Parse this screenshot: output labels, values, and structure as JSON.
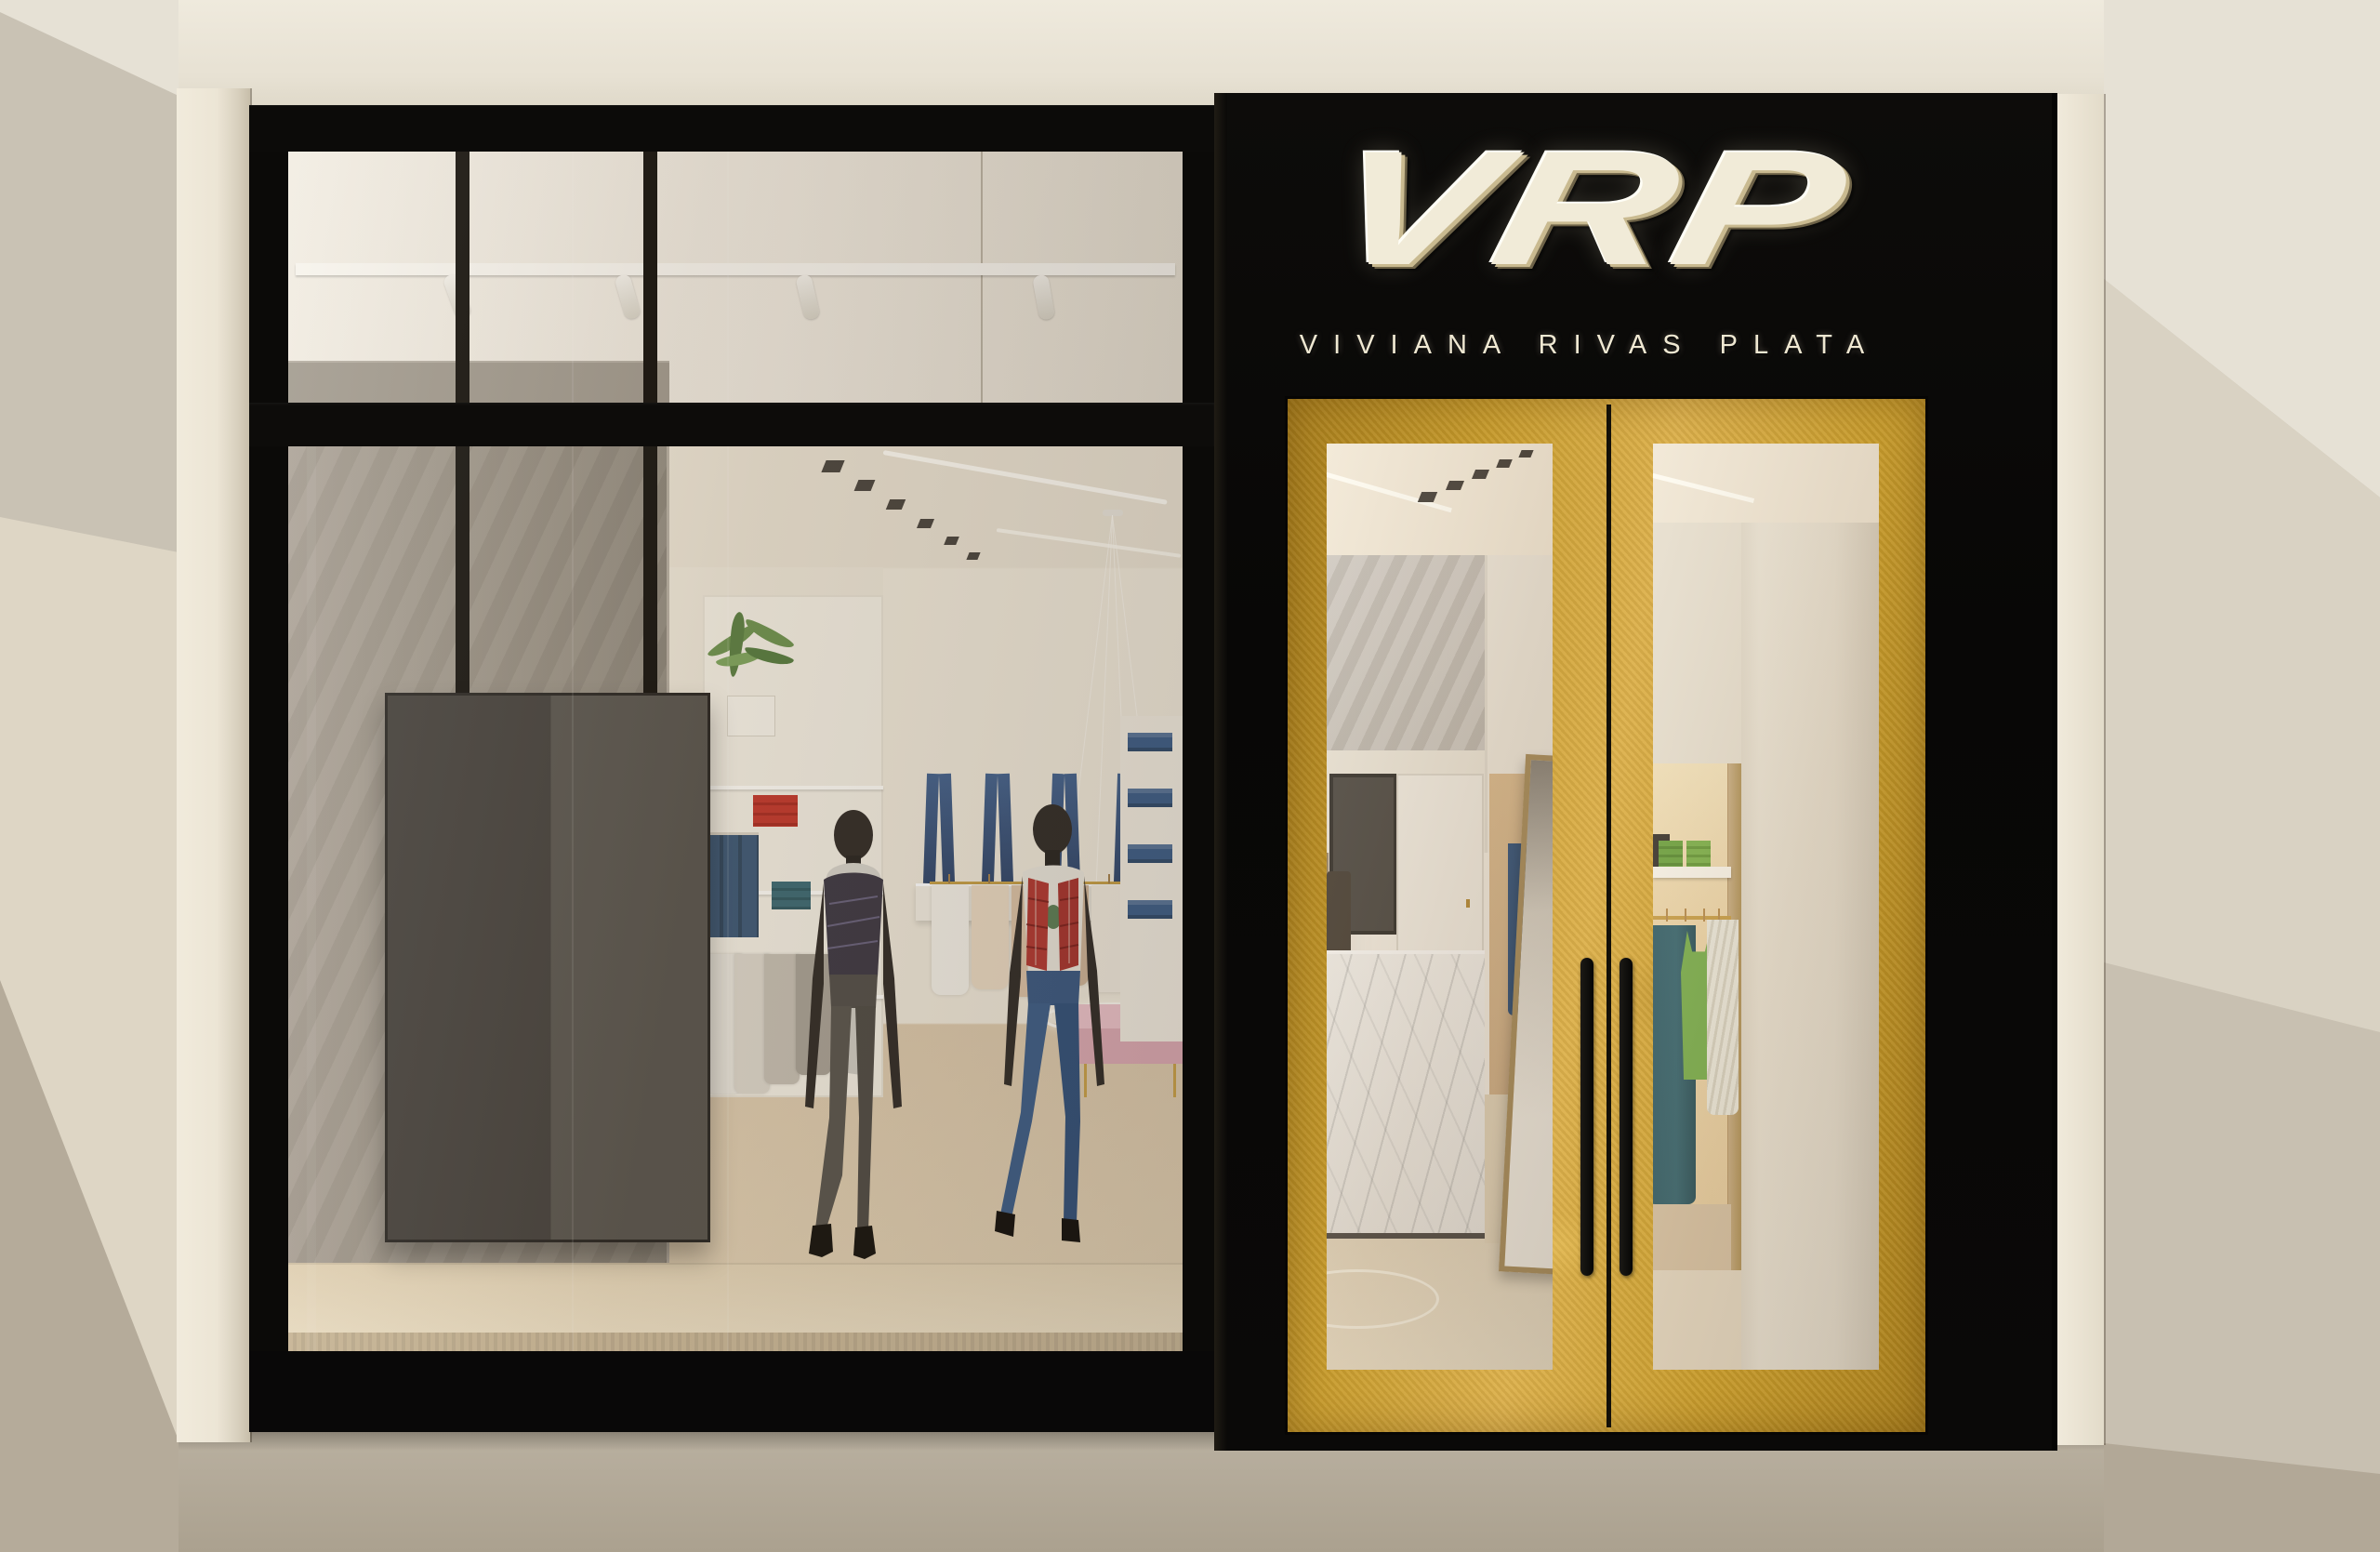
{
  "brand": {
    "logo_text": "VRP",
    "subtitle": "VIVIANA RIVAS PLATA"
  },
  "theme": {
    "facade_black": "#0b0a08",
    "door_gold": "#c79b2c",
    "door_gold_light": "#ddb14c",
    "door_gold_dark": "#a87e1c",
    "logo_cream": "#f1ebd8",
    "subtitle_cream": "#efe8d2",
    "mall_wall": "#cfc8b9",
    "mall_ceiling": "#e6e1d5",
    "mall_floor": "#b2a897",
    "fascia": "#e9e4d8",
    "pilaster": "#ece5d5",
    "interior_wall": "#efe8da",
    "concrete_wall": "#a09a8e",
    "wood_floor": "#dcc9ac",
    "platform_wood": "#e9dabf",
    "panel_gray": "#4a4641",
    "denim_blue": "#3f5f88",
    "mannequin_skin": "#332e29",
    "vest_red": "#b23a33",
    "scarf_gray": "#cfccc3",
    "plant_green": "#6f9350",
    "clothes_green": "#7cb152",
    "clothes_teal": "#3c6a74"
  }
}
